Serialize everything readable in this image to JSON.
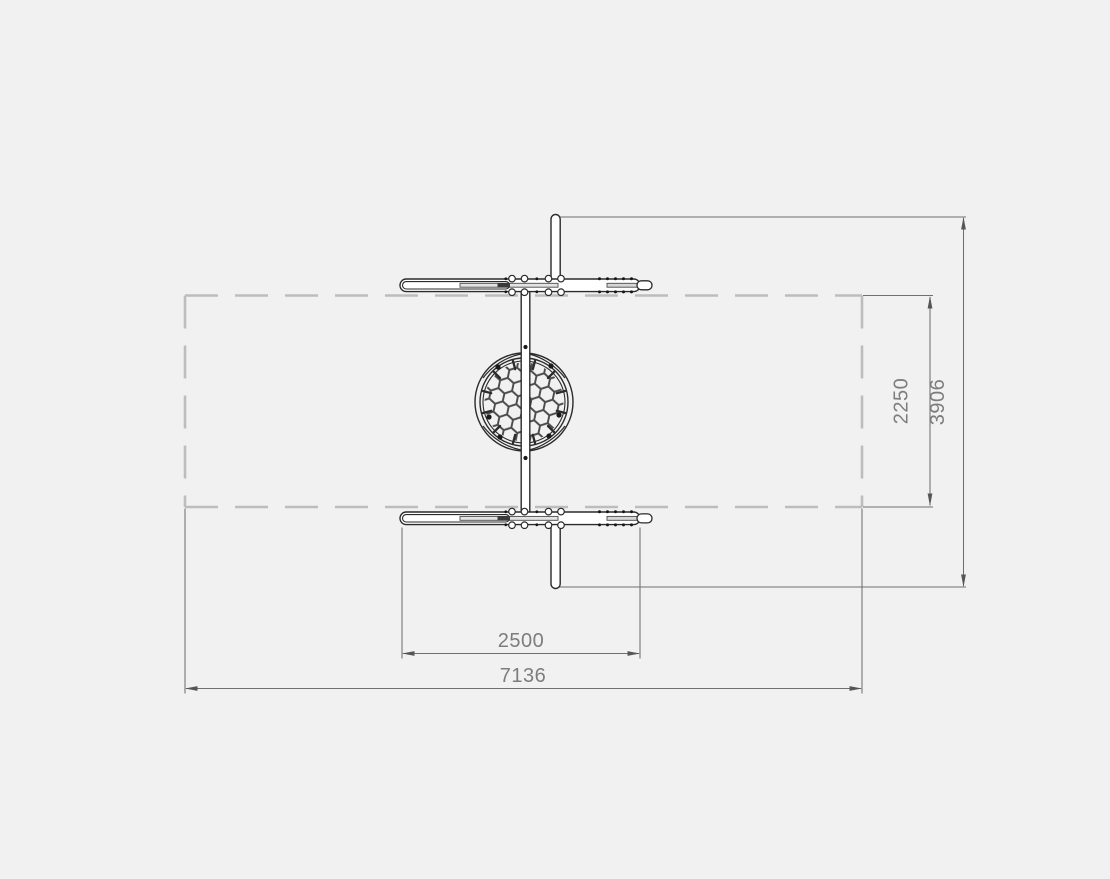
{
  "diagram": {
    "background": "#f1f1f2",
    "colors": {
      "equipment_outline": "#2b2b2b",
      "mesh_rope": "#4a4a4a",
      "dimension_line": "#707070",
      "arrowhead": "#565656",
      "label_text": "#7d7d7d",
      "safety_zone_dash": "#bcbdbd"
    },
    "labels": {
      "d2250": "2250",
      "d3906": "3906",
      "d2500": "2500",
      "d7136": "7136"
    }
  }
}
